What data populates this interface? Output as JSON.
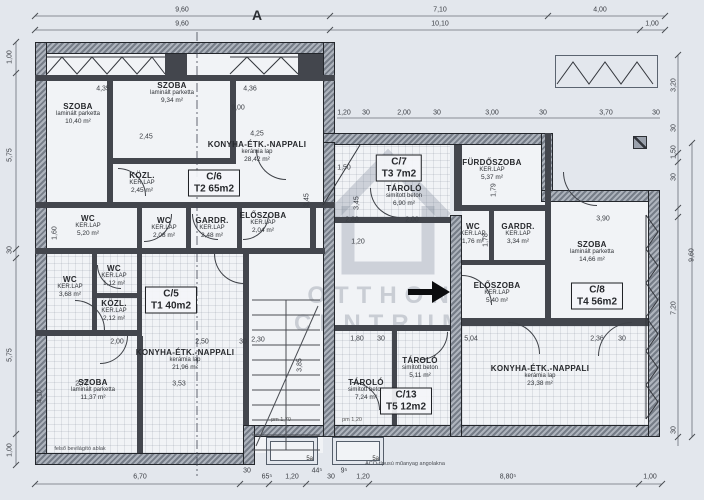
{
  "sheet": {
    "grid_label": "A",
    "watermark": {
      "line1": "OTTHON",
      "line2": "CENTRUM"
    },
    "units": [
      {
        "code": "C/5",
        "size": "T1 40m2"
      },
      {
        "code": "C/6",
        "size": "T2 65m2"
      },
      {
        "code": "C/7",
        "size": "T3 7m2"
      },
      {
        "code": "C/8",
        "size": "T4 56m2"
      },
      {
        "code": "C/13",
        "size": "T5 12m2"
      }
    ],
    "unit_tags": [
      {
        "code": "C/6",
        "size": "T2 65m2",
        "x": 214,
        "y": 183
      },
      {
        "code": "C/5",
        "size": "T1 40m2",
        "x": 171,
        "y": 300
      },
      {
        "code": "C/7",
        "size": "T3 7m2",
        "x": 399,
        "y": 168
      },
      {
        "code": "C/8",
        "size": "T4 56m2",
        "x": 597,
        "y": 296
      },
      {
        "code": "C/13",
        "size": "T5 12m2",
        "x": 406,
        "y": 401
      }
    ],
    "rooms": [
      {
        "name": "SZOBA",
        "finish": "laminált parketta",
        "area": "10,40 m²",
        "x": 78,
        "y": 114
      },
      {
        "name": "SZOBA",
        "finish": "laminált parketta",
        "area": "9,34 m²",
        "x": 172,
        "y": 93
      },
      {
        "name": "KONYHA-ÉTK.-NAPPALI",
        "finish": "kerámia lap",
        "area": "28,42 m²",
        "x": 257,
        "y": 152
      },
      {
        "name": "KÖZL.",
        "finish": "KER.LAP",
        "area": "2,45 m²",
        "x": 142,
        "y": 183
      },
      {
        "name": "WC",
        "finish": "KER.LAP",
        "area": "5,20 m²",
        "x": 88,
        "y": 226
      },
      {
        "name": "WC",
        "finish": "KER.LAP",
        "area": "2,08 m²",
        "x": 164,
        "y": 228
      },
      {
        "name": "GARDR.",
        "finish": "KER.LAP",
        "area": "2,48 m²",
        "x": 212,
        "y": 228
      },
      {
        "name": "ELŐSZOBA",
        "finish": "KER.LAP",
        "area": "2,04 m²",
        "x": 263,
        "y": 223
      },
      {
        "name": "WC",
        "finish": "KER.LAP",
        "area": "3,68 m²",
        "x": 70,
        "y": 287
      },
      {
        "name": "WC",
        "finish": "KER.LAP",
        "area": "1,12 m²",
        "x": 114,
        "y": 276
      },
      {
        "name": "KÖZL.",
        "finish": "KER.LAP",
        "area": "2,12 m²",
        "x": 114,
        "y": 311
      },
      {
        "name": "KONYHA-ÉTK.-NAPPALI",
        "finish": "kerámia lap",
        "area": "21,96 m²",
        "x": 185,
        "y": 360
      },
      {
        "name": "SZOBA",
        "finish": "laminált parketta",
        "area": "11,37 m²",
        "x": 93,
        "y": 390
      },
      {
        "name": "TÁROLÓ",
        "finish": "simított beton",
        "area": "6,90 m²",
        "x": 404,
        "y": 196
      },
      {
        "name": "TÁROLÓ",
        "finish": "simított beton",
        "area": "7,24 m²",
        "x": 366,
        "y": 390
      },
      {
        "name": "TÁROLÓ",
        "finish": "simított beton",
        "area": "5,11 m²",
        "x": 420,
        "y": 368
      },
      {
        "name": "FÜRDŐSZOBA",
        "finish": "KER.LAP",
        "area": "5,37 m²",
        "x": 492,
        "y": 170
      },
      {
        "name": "WC",
        "finish": "KER.LAP",
        "area": "1,76 m²",
        "x": 473,
        "y": 234
      },
      {
        "name": "GARDR.",
        "finish": "KER.LAP",
        "area": "3,34 m²",
        "x": 518,
        "y": 234
      },
      {
        "name": "SZOBA",
        "finish": "laminált parketta",
        "area": "14,66 m²",
        "x": 592,
        "y": 252
      },
      {
        "name": "ELŐSZOBA",
        "finish": "KER.LAP",
        "area": "5,40 m²",
        "x": 497,
        "y": 293
      },
      {
        "name": "KONYHA-ÉTK.-NAPPALI",
        "finish": "kerámia lap",
        "area": "23,38 m²",
        "x": 540,
        "y": 376
      }
    ],
    "dims": [
      {
        "t": "9,60",
        "x": 182,
        "y": 10
      },
      {
        "t": "7,10",
        "x": 440,
        "y": 10
      },
      {
        "t": "4,00",
        "x": 600,
        "y": 10
      },
      {
        "t": "9,60",
        "x": 182,
        "y": 24
      },
      {
        "t": "10,10",
        "x": 440,
        "y": 24
      },
      {
        "t": "1,00",
        "x": 652,
        "y": 24
      },
      {
        "t": "1,00",
        "x": 10,
        "y": 57,
        "cls": "rot"
      },
      {
        "t": "5,75",
        "x": 10,
        "y": 155,
        "cls": "rot"
      },
      {
        "t": "30",
        "x": 10,
        "y": 250,
        "cls": "rot"
      },
      {
        "t": "5,75",
        "x": 10,
        "y": 355,
        "cls": "rot"
      },
      {
        "t": "1,00",
        "x": 10,
        "y": 450,
        "cls": "rot"
      },
      {
        "t": "3,20",
        "x": 674,
        "y": 85,
        "cls": "rot"
      },
      {
        "t": "30",
        "x": 674,
        "y": 128,
        "cls": "rot"
      },
      {
        "t": "1,50",
        "x": 674,
        "y": 152,
        "cls": "rot"
      },
      {
        "t": "30",
        "x": 674,
        "y": 177,
        "cls": "rot"
      },
      {
        "t": "7,20",
        "x": 674,
        "y": 308,
        "cls": "rot"
      },
      {
        "t": "30",
        "x": 674,
        "y": 430,
        "cls": "rot"
      },
      {
        "t": "9,60",
        "x": 692,
        "y": 255,
        "cls": "rot"
      },
      {
        "t": "6,70",
        "x": 140,
        "y": 477
      },
      {
        "t": "30",
        "x": 247,
        "y": 471
      },
      {
        "t": "65⁵",
        "x": 267,
        "y": 477
      },
      {
        "t": "1,20",
        "x": 292,
        "y": 477
      },
      {
        "t": "44⁵",
        "x": 317,
        "y": 471
      },
      {
        "t": "30",
        "x": 331,
        "y": 477
      },
      {
        "t": "9⁵",
        "x": 344,
        "y": 471
      },
      {
        "t": "1,20",
        "x": 363,
        "y": 477
      },
      {
        "t": "8,80⁵",
        "x": 508,
        "y": 477
      },
      {
        "t": "1,00",
        "x": 650,
        "y": 477
      },
      {
        "t": "1,20",
        "x": 344,
        "y": 113
      },
      {
        "t": "30",
        "x": 366,
        "y": 113
      },
      {
        "t": "2,00",
        "x": 404,
        "y": 113
      },
      {
        "t": "30",
        "x": 437,
        "y": 113
      },
      {
        "t": "3,00",
        "x": 492,
        "y": 113
      },
      {
        "t": "30",
        "x": 543,
        "y": 113
      },
      {
        "t": "3,70",
        "x": 606,
        "y": 113
      },
      {
        "t": "30",
        "x": 656,
        "y": 113
      },
      {
        "t": "4,35",
        "x": 103,
        "y": 89
      },
      {
        "t": "4,36",
        "x": 250,
        "y": 89
      },
      {
        "t": "9,00",
        "x": 238,
        "y": 108
      },
      {
        "t": "2,45",
        "x": 146,
        "y": 137
      },
      {
        "t": "4,25",
        "x": 257,
        "y": 134
      },
      {
        "t": "3,45",
        "x": 307,
        "y": 200,
        "cls": "rot"
      },
      {
        "t": "3,45",
        "x": 357,
        "y": 203,
        "cls": "rot"
      },
      {
        "t": "1,50",
        "x": 344,
        "y": 168
      },
      {
        "t": "2,80",
        "x": 352,
        "y": 220
      },
      {
        "t": "2,00",
        "x": 412,
        "y": 220
      },
      {
        "t": "1,20",
        "x": 358,
        "y": 242
      },
      {
        "t": "3,90",
        "x": 603,
        "y": 219
      },
      {
        "t": "1,79",
        "x": 494,
        "y": 190,
        "cls": "rot"
      },
      {
        "t": "1,78",
        "x": 486,
        "y": 240,
        "cls": "rot"
      },
      {
        "t": "1,60",
        "x": 55,
        "y": 233,
        "cls": "rot"
      },
      {
        "t": "2,00",
        "x": 117,
        "y": 342
      },
      {
        "t": "2,50",
        "x": 202,
        "y": 342
      },
      {
        "t": "30",
        "x": 243,
        "y": 342
      },
      {
        "t": "2,77",
        "x": 82,
        "y": 384
      },
      {
        "t": "3,53",
        "x": 179,
        "y": 384
      },
      {
        "t": "4,10",
        "x": 40,
        "y": 396,
        "cls": "rot"
      },
      {
        "t": "2,30",
        "x": 258,
        "y": 340
      },
      {
        "t": "3,85",
        "x": 300,
        "y": 365,
        "cls": "rot"
      },
      {
        "t": "1,80",
        "x": 357,
        "y": 339
      },
      {
        "t": "30",
        "x": 381,
        "y": 339
      },
      {
        "t": "5,04",
        "x": 471,
        "y": 339
      },
      {
        "t": "2,36",
        "x": 597,
        "y": 339
      },
      {
        "t": "30",
        "x": 622,
        "y": 339
      },
      {
        "t": "pm 1,70",
        "x": 281,
        "y": 420,
        "cls": "tiny"
      },
      {
        "t": "pm 1,20",
        "x": 352,
        "y": 420,
        "cls": "tiny"
      }
    ],
    "notes": [
      {
        "t": "ACO-típusú műanyag angolakna",
        "x": 405,
        "y": 464,
        "cls": "note"
      },
      {
        "t": "felső bevilágító ablak",
        "x": 80,
        "y": 449,
        "cls": "note"
      }
    ],
    "wells": [
      {
        "x": 266,
        "y": 437,
        "w": 52,
        "h": 28,
        "label": "5a"
      },
      {
        "x": 332,
        "y": 437,
        "w": 52,
        "h": 28,
        "label": "5a"
      }
    ]
  }
}
